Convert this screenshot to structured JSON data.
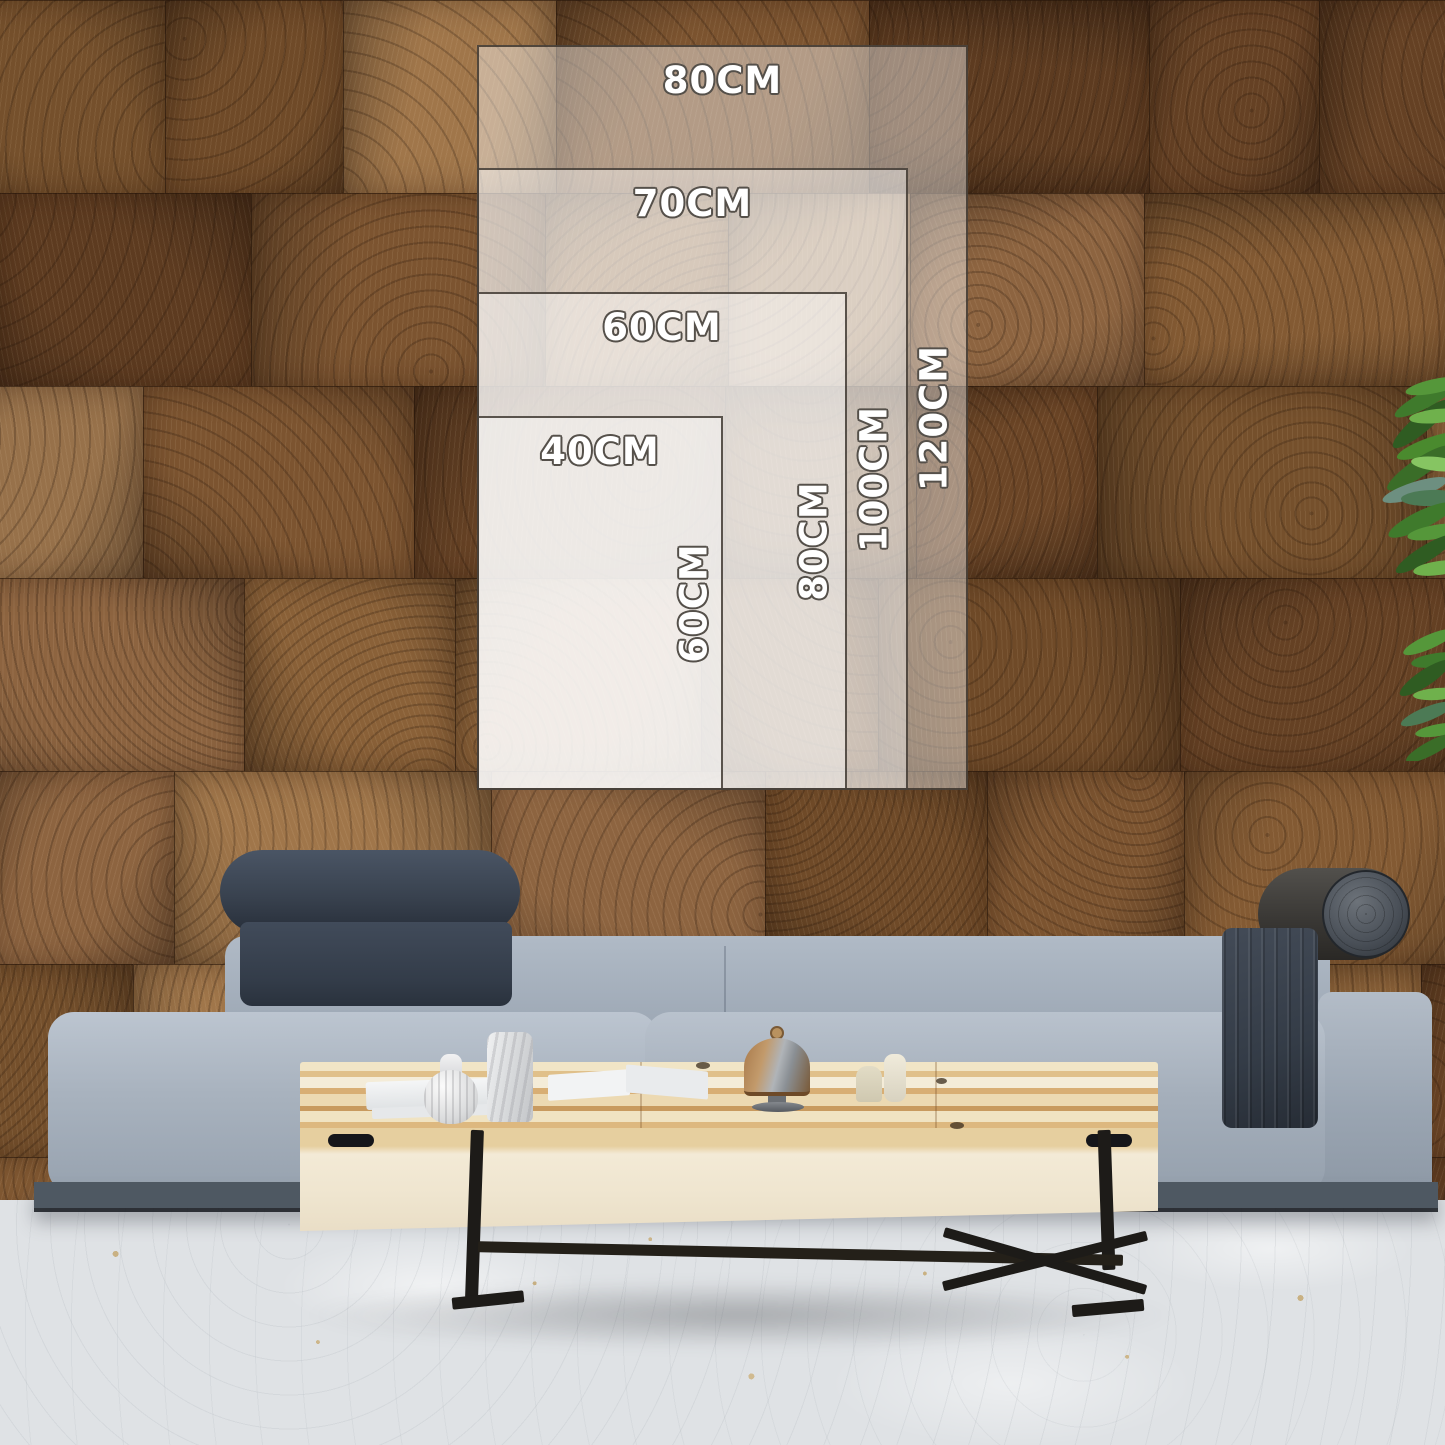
{
  "size_guide": {
    "sizes": [
      {
        "id": "80x120",
        "width_label": "80CM",
        "height_label": "120CM"
      },
      {
        "id": "70x100",
        "width_label": "70CM",
        "height_label": "100CM"
      },
      {
        "id": "60x80",
        "width_label": "60CM",
        "height_label": "80CM"
      },
      {
        "id": "40x60",
        "width_label": "40CM",
        "height_label": "60CM"
      }
    ]
  },
  "colors": {
    "overlay_fill": "rgba(255,255,255,0.42)",
    "overlay_border": "#342d26",
    "label_text": "#ffffff",
    "label_outline": "#55504a",
    "wall_wood": "#7a5230",
    "sofa_fabric": "#a3aebb",
    "headrest_fabric": "#3a4250",
    "table_top_wood": "#e9d5a9",
    "table_front_wood": "#f0e6d0",
    "floor": "#e0e3e6",
    "plant_green": "#4f8a33"
  }
}
